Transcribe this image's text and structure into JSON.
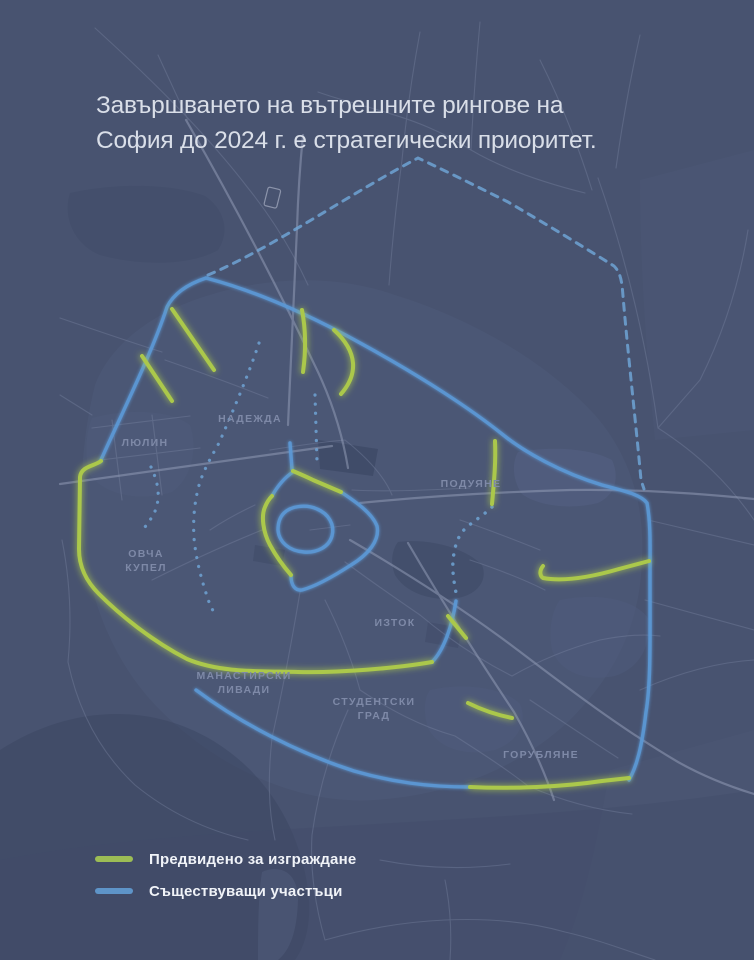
{
  "title": {
    "line1": "Завършването на вътрешните рингове на",
    "line2": "София до 2024 г. е стратегически приоритет."
  },
  "map": {
    "labels": [
      {
        "id": "nadezhda",
        "text": "НАДЕЖДА"
      },
      {
        "id": "lyulin",
        "text": "ЛЮЛИН"
      },
      {
        "id": "poduyane",
        "text": "ПОДУЯНЕ"
      },
      {
        "id": "ovcha-kupel",
        "text": "ОВЧА\nКУПЕЛ"
      },
      {
        "id": "iztok",
        "text": "ИЗТОК"
      },
      {
        "id": "manastirski-livadi",
        "text": "МАНАСТИРСКИ\nЛИВАДИ"
      },
      {
        "id": "studentski-grad",
        "text": "СТУДЕНТСКИ\nГРАД"
      },
      {
        "id": "gorublyane",
        "text": "ГОРУБЛЯНЕ"
      }
    ],
    "colors": {
      "background": "#485370",
      "planned_green": "#abc84b",
      "existing_blue": "#5b99d6",
      "dashed_blue": "#6fa3d4",
      "label_gray": "#7e89a7"
    }
  },
  "legend": {
    "items": [
      {
        "type": "planned",
        "label": "Предвидено за изграждане",
        "color": "#9cbd55"
      },
      {
        "type": "existing",
        "label": "Съществуващи участъци",
        "color": "#5e94c8"
      }
    ]
  }
}
